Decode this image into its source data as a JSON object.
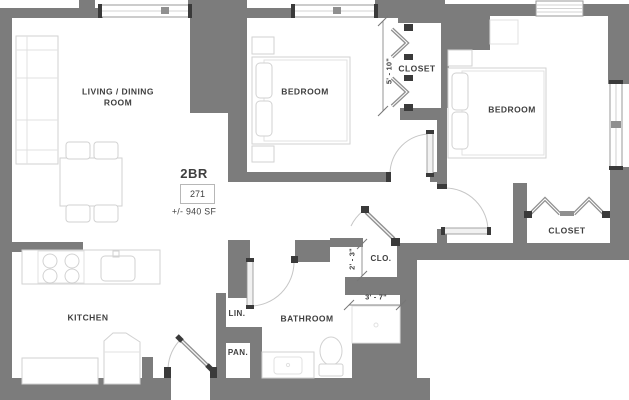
{
  "colors": {
    "wall": "#7c7c7c",
    "floor": "#ffffff",
    "furniture": "#d2d2d2",
    "door": "#8f8f8f",
    "jamb": "#3a3a3a",
    "arc": "#c6c6c6",
    "window_frame": "#9a9a9a",
    "dim": "#8a8a8a",
    "text": "#3f3f3f"
  },
  "unit": {
    "type": "2BR",
    "number": "271",
    "area": "+/- 940 SF"
  },
  "rooms": {
    "living_dining": "LIVING / DINING ROOM",
    "bedroom_1": "BEDROOM",
    "bedroom_2": "BEDROOM",
    "closet_top": "CLOSET",
    "closet_right": "CLOSET",
    "closet_small": "CLO.",
    "bathroom": "BATHROOM",
    "kitchen": "KITCHEN",
    "linen": "LIN.",
    "pantry": "PAN."
  },
  "dimensions": {
    "closet_top": "5' - 10\"",
    "closet_small": "2' - 3\"",
    "shower": "3' - 7\""
  }
}
